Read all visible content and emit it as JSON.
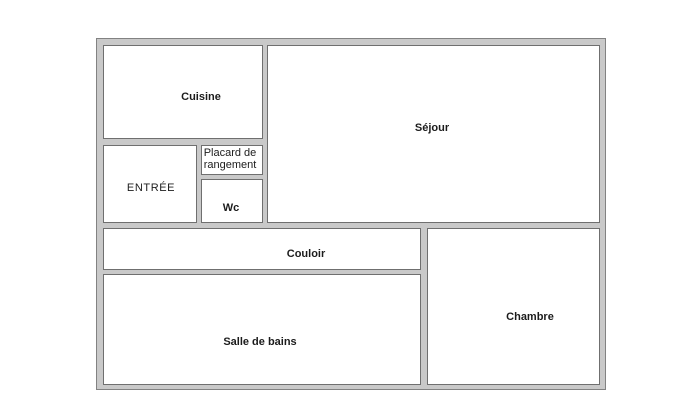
{
  "floor_plan": {
    "type": "apartment-floor-plan",
    "rooms": {
      "cuisine": {
        "label": "Cuisine"
      },
      "sejour": {
        "label": "Séjour"
      },
      "entree": {
        "label": "ENTRÉE"
      },
      "placard": {
        "label": "Placard de rangement"
      },
      "wc": {
        "label": "Wc"
      },
      "couloir": {
        "label": "Couloir"
      },
      "salle_de_bains": {
        "label": "Salle de bains"
      },
      "chambre": {
        "label": "Chambre"
      }
    },
    "colors": {
      "page_background": "#ffffff",
      "wall_fill": "#c9c9c9",
      "wall_outline": "#828282",
      "room_border": "#6f6f6f",
      "room_fill": "#ffffff",
      "label_text": "#1c1c1c"
    }
  }
}
